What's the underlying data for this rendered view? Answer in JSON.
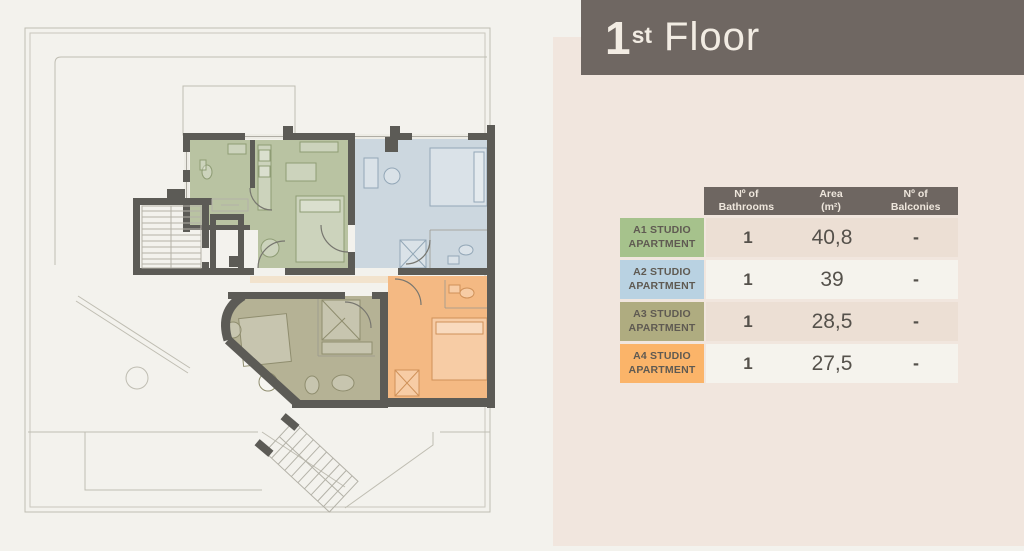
{
  "title": {
    "number": "1",
    "suffix": "st",
    "word": "Floor"
  },
  "table": {
    "headers": [
      {
        "line1": "Nº of",
        "line2": "Bathrooms"
      },
      {
        "line1": "Area",
        "line2": "(m²)"
      },
      {
        "line1": "Nº of",
        "line2": "Balconies"
      }
    ],
    "rows": [
      {
        "label_line1": "A1 STUDIO",
        "label_line2": "APARTMENT",
        "color": "#a6c28c",
        "bathrooms": "1",
        "area": "40,8",
        "balconies": "-"
      },
      {
        "label_line1": "A2 STUDIO",
        "label_line2": "APARTMENT",
        "color": "#b9d2e2",
        "bathrooms": "1",
        "area": "39",
        "balconies": "-"
      },
      {
        "label_line1": "A3 STUDIO",
        "label_line2": "APARTMENT",
        "color": "#afac80",
        "bathrooms": "1",
        "area": "28,5",
        "balconies": "-"
      },
      {
        "label_line1": "A4 STUDIO",
        "label_line2": "APARTMENT",
        "color": "#fbb469",
        "bathrooms": "1",
        "area": "27,5",
        "balconies": "-"
      }
    ]
  },
  "floorplan": {
    "rooms": [
      {
        "id": "a1",
        "name": "A1 Studio Apartment",
        "color": "#b9c3a2"
      },
      {
        "id": "a2",
        "name": "A2 Studio Apartment",
        "color": "#ccd7df"
      },
      {
        "id": "a3",
        "name": "A3 Studio Apartment",
        "color": "#b5b295"
      },
      {
        "id": "a4",
        "name": "A4 Studio Apartment",
        "color": "#f4b983"
      }
    ],
    "wall_color": "#5c5b56",
    "accent_header_color": "#6f6762",
    "panel_color": "#f1e6de"
  }
}
